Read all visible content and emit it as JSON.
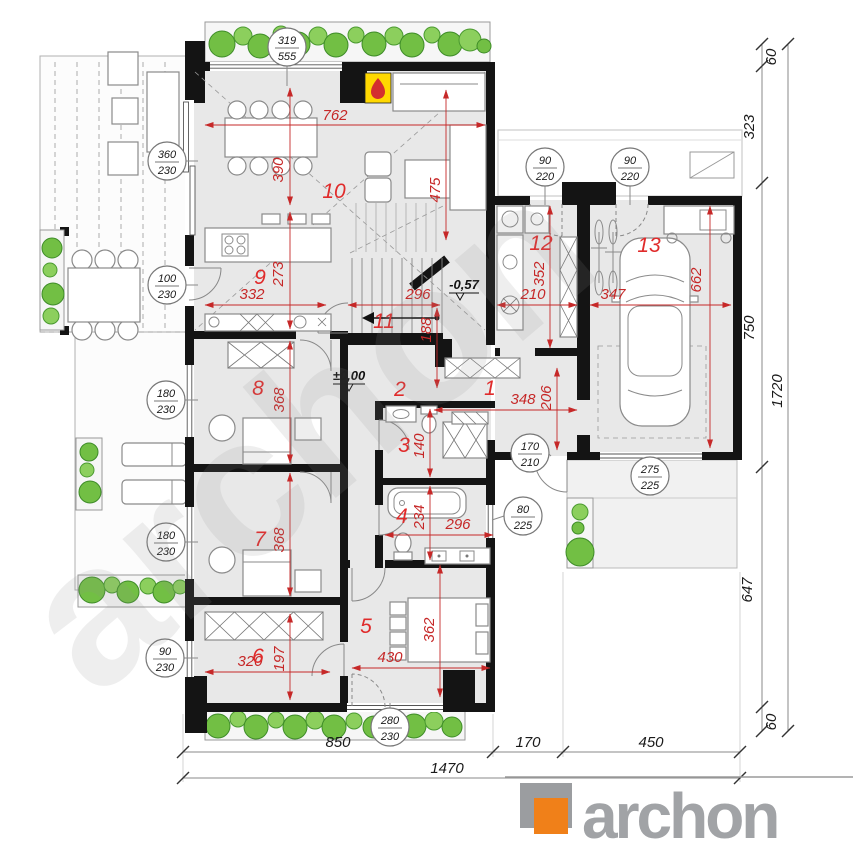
{
  "watermark": "archon",
  "logo": {
    "brand": "archon"
  },
  "rooms": {
    "r1": "1",
    "r2": "2",
    "r3": "3",
    "r4": "4",
    "r5": "5",
    "r6": "6",
    "r7": "7",
    "r8": "8",
    "r9": "9",
    "r10": "10",
    "r11": "11",
    "r12": "12",
    "r13": "13"
  },
  "levels": {
    "ground": "±0,00",
    "stair": "-0,57"
  },
  "dims": {
    "d762": "762",
    "d390": "390",
    "d475": "475",
    "d332": "332",
    "d273": "273",
    "d296_stair": "296",
    "d188": "188",
    "d210": "210",
    "d352": "352",
    "d347": "347",
    "d662": "662",
    "d368_r8": "368",
    "d368_r7": "368",
    "d140": "140",
    "d234": "234",
    "d296_bath": "296",
    "d348": "348",
    "d206": "206",
    "d320": "320",
    "d197": "197",
    "d430": "430",
    "d362": "362"
  },
  "bubbles": {
    "b319_555": {
      "top": "319",
      "bottom": "555"
    },
    "b360_230": {
      "top": "360",
      "bottom": "230"
    },
    "b100_230": {
      "top": "100",
      "bottom": "230"
    },
    "b180_230_a": {
      "top": "180",
      "bottom": "230"
    },
    "b180_230_b": {
      "top": "180",
      "bottom": "230"
    },
    "b90_230": {
      "top": "90",
      "bottom": "230"
    },
    "b90_220_a": {
      "top": "90",
      "bottom": "220"
    },
    "b90_220_b": {
      "top": "90",
      "bottom": "220"
    },
    "b170_210": {
      "top": "170",
      "bottom": "210"
    },
    "b80_225": {
      "top": "80",
      "bottom": "225"
    },
    "b275_225": {
      "top": "275",
      "bottom": "225"
    },
    "b280_230": {
      "top": "280",
      "bottom": "230"
    }
  },
  "chain_right": {
    "seg60_top": "60",
    "seg323": "323",
    "seg750": "750",
    "seg647": "647",
    "seg60_bottom": "60",
    "total": "1720"
  },
  "chain_bottom": {
    "seg850": "850",
    "seg170": "170",
    "seg450": "450",
    "total": "1470"
  },
  "colors": {
    "dim_red": "#c62828",
    "wall": "#141414",
    "plant_green": "#72bf44",
    "logo_orange": "#f08019",
    "logo_gray": "#9da0a3",
    "floor_gray": "#e8e8e8",
    "fireplace_yellow": "#ffd800"
  }
}
